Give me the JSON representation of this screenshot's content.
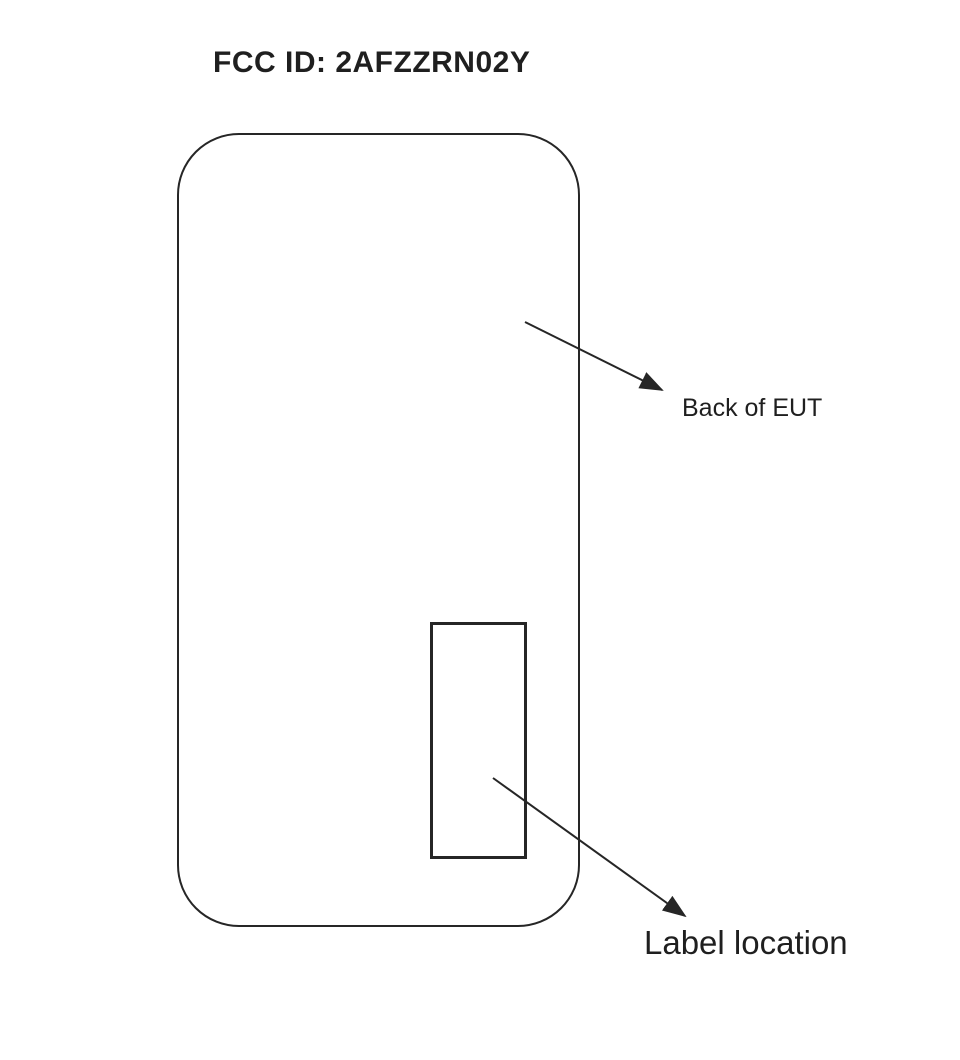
{
  "title": "FCC ID: 2AFZZRN02Y",
  "diagram": {
    "device": {
      "description_shape": "rounded-rectangle-device-back"
    },
    "annotations": {
      "back_of_eut": "Back of EUT",
      "label_location": "Label location"
    }
  },
  "colors": {
    "background": "#ffffff",
    "line": "#262626",
    "text": "#1f1f1f"
  }
}
